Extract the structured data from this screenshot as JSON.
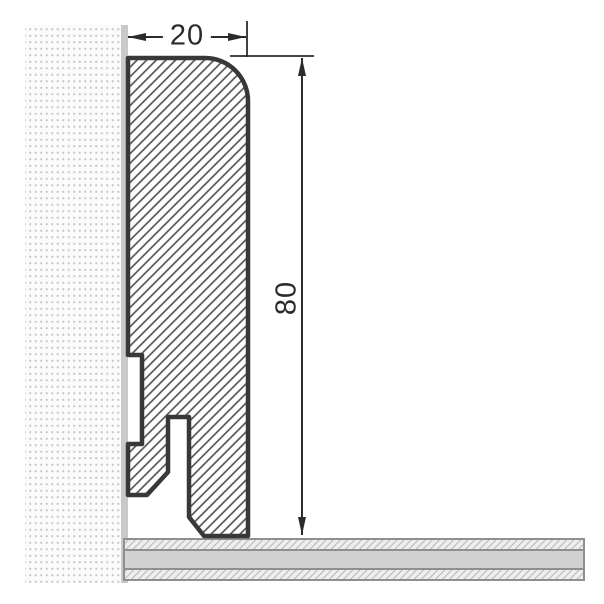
{
  "drawing": {
    "dimensions": {
      "width_label": "20",
      "height_label": "80"
    },
    "colors": {
      "profile_outline": "#383838",
      "profile_hatch_line": "#4d4d4d",
      "wall_dot": "#c4c4c4",
      "wall_surface_strip": "#c9c9c9",
      "floor_middle_gray": "#d2d2d2",
      "floor_layer_line": "#8f8f8f",
      "floor_hatch_line": "#b5b5b5",
      "dimension_line": "#2b2b2b"
    }
  }
}
